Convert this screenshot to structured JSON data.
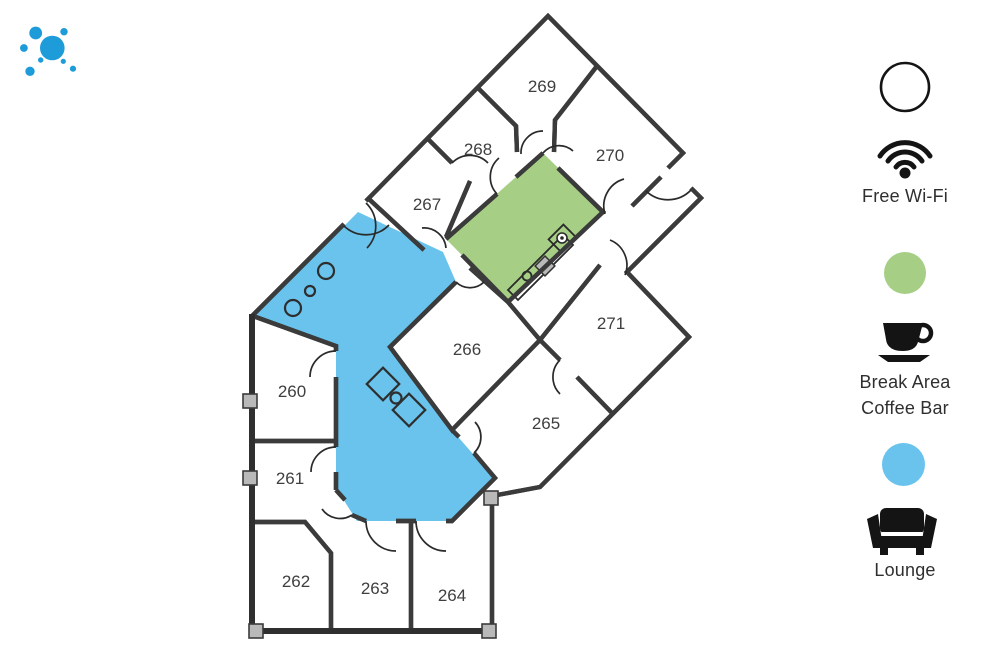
{
  "logo": {
    "icon": "dot-cluster-logo"
  },
  "floorplan": {
    "rooms": [
      {
        "number": "260",
        "x": 292,
        "y": 391
      },
      {
        "number": "261",
        "x": 290,
        "y": 478
      },
      {
        "number": "262",
        "x": 296,
        "y": 581
      },
      {
        "number": "263",
        "x": 375,
        "y": 588
      },
      {
        "number": "264",
        "x": 452,
        "y": 595
      },
      {
        "number": "265",
        "x": 546,
        "y": 423
      },
      {
        "number": "266",
        "x": 467,
        "y": 349
      },
      {
        "number": "267",
        "x": 427,
        "y": 204
      },
      {
        "number": "268",
        "x": 478,
        "y": 149
      },
      {
        "number": "269",
        "x": 542,
        "y": 86
      },
      {
        "number": "270",
        "x": 610,
        "y": 155
      },
      {
        "number": "271",
        "x": 611,
        "y": 323
      }
    ],
    "areas": [
      {
        "name": "lounge",
        "color_key": "lounge_blue"
      },
      {
        "name": "break-area-coffee-bar",
        "color_key": "break_green"
      }
    ]
  },
  "legend": {
    "wifi_label": "Free Wi-Fi",
    "break_label_line1": "Break Area",
    "break_label_line2": "Coffee Bar",
    "lounge_label": "Lounge"
  },
  "colors": {
    "brand_blue": "#1E9CD9",
    "lounge_blue": "#69C3EC",
    "break_green": "#A6CF85",
    "wall": "#3B3B3B",
    "column_gray": "#B9B9B9",
    "icon_black": "#141414",
    "label_text": "#3F3F3F"
  }
}
